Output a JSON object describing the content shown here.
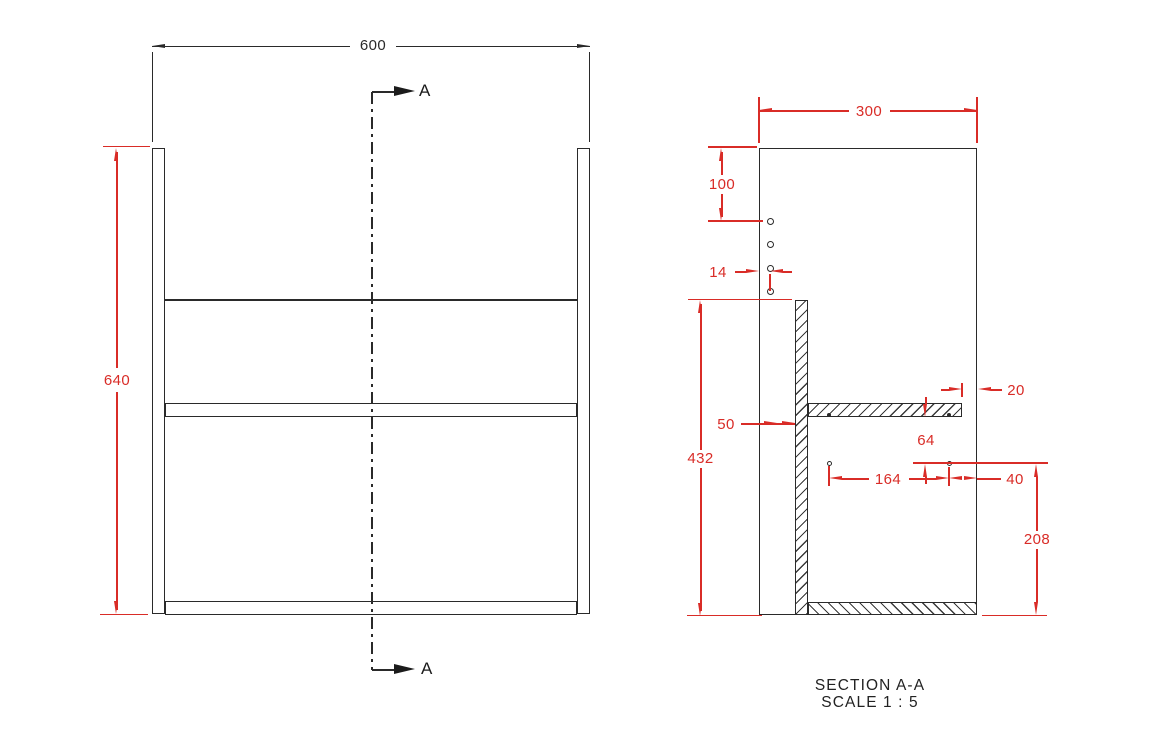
{
  "front_view": {
    "width_label": "600",
    "height_label": "640",
    "section_marker_label": "A"
  },
  "section_view": {
    "title": "SECTION A-A",
    "scale": "SCALE 1 : 5",
    "depth_label": "300",
    "top_to_holes_label": "100",
    "hole_edge_offset_label": "14",
    "back_panel_inset_label": "50",
    "back_panel_height_label": "432",
    "shelf_front_gap_label": "20",
    "shelf_to_holes_label": "64",
    "hole_spacing_label": "164",
    "hole_to_front_label": "40",
    "holes_to_bottom_label": "208"
  },
  "colors": {
    "dimension_red": "#d92c27",
    "line_black": "#2a2a2a",
    "background": "#ffffff"
  }
}
